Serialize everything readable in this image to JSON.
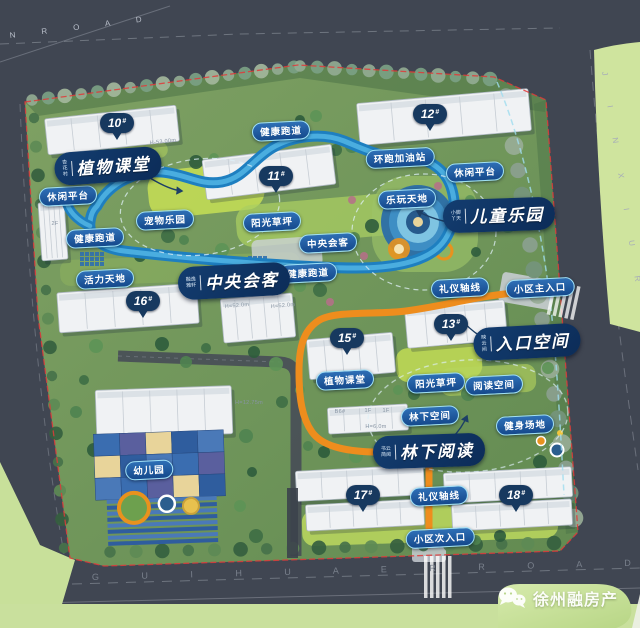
{
  "title": "residential community landscape master plan",
  "roads": {
    "top": "N  R O A D",
    "right": "J I N   X I U   R O A D",
    "bottom": "G U I   H U A   E R   R O A D"
  },
  "site": {
    "feature_labels": [
      {
        "text": "植物课堂",
        "prefix_lines": [
          "杏",
          "花",
          "村"
        ],
        "x": 108,
        "y": 166,
        "rot": -4
      },
      {
        "text": "中央会客",
        "prefix_lines": [
          "融逸",
          "雅轩"
        ],
        "x": 234,
        "y": 281,
        "rot": -3
      },
      {
        "text": "儿童乐园",
        "prefix_lines": [
          "小脚",
          "丫天"
        ],
        "x": 499,
        "y": 215,
        "rot": -2
      },
      {
        "text": "入口空间",
        "prefix_lines": [
          "映",
          "云",
          "间"
        ],
        "x": 527,
        "y": 342,
        "rot": -3
      },
      {
        "text": "林下阅读",
        "prefix_lines": [
          "书云",
          "简阅"
        ],
        "x": 429,
        "y": 451,
        "rot": -2
      }
    ],
    "amenity_pills": [
      {
        "text": "健康跑道",
        "x": 281,
        "y": 131
      },
      {
        "text": "环跑加油站",
        "x": 400,
        "y": 158
      },
      {
        "text": "休闲平台",
        "x": 475,
        "y": 172
      },
      {
        "text": "乐玩天地",
        "x": 407,
        "y": 199
      },
      {
        "text": "休闲平台",
        "x": 68,
        "y": 196
      },
      {
        "text": "宠物乐园",
        "x": 165,
        "y": 220
      },
      {
        "text": "阳光草坪",
        "x": 272,
        "y": 222
      },
      {
        "text": "中央会客",
        "x": 328,
        "y": 243
      },
      {
        "text": "健康跑道",
        "x": 95,
        "y": 238
      },
      {
        "text": "健康跑道",
        "x": 308,
        "y": 273
      },
      {
        "text": "活力天地",
        "x": 105,
        "y": 279
      },
      {
        "text": "礼仪轴线",
        "x": 460,
        "y": 288
      },
      {
        "text": "小区主入口",
        "x": 540,
        "y": 288
      },
      {
        "text": "植物课堂",
        "x": 345,
        "y": 380
      },
      {
        "text": "阳光草坪",
        "x": 436,
        "y": 383
      },
      {
        "text": "阅读空间",
        "x": 494,
        "y": 385
      },
      {
        "text": "林下空间",
        "x": 430,
        "y": 416
      },
      {
        "text": "健身场地",
        "x": 525,
        "y": 425
      },
      {
        "text": "礼仪轴线",
        "x": 439,
        "y": 496
      },
      {
        "text": "小区次入口",
        "x": 440,
        "y": 538
      },
      {
        "text": "幼儿园",
        "x": 149,
        "y": 470
      }
    ],
    "building_pins": [
      {
        "num": "10",
        "hash": "#",
        "x": 117,
        "y": 140
      },
      {
        "num": "11",
        "hash": "#",
        "x": 276,
        "y": 193
      },
      {
        "num": "12",
        "hash": "#",
        "x": 430,
        "y": 131
      },
      {
        "num": "13",
        "hash": "#",
        "x": 451,
        "y": 341
      },
      {
        "num": "15",
        "hash": "#",
        "x": 347,
        "y": 355
      },
      {
        "num": "16",
        "hash": "#",
        "x": 143,
        "y": 318
      },
      {
        "num": "17",
        "hash": "#",
        "x": 363,
        "y": 512
      },
      {
        "num": "18",
        "hash": "#",
        "x": 516,
        "y": 512
      }
    ],
    "building_notes": [
      {
        "text": "H-53.00m",
        "x": 163,
        "y": 142,
        "rot": -6
      },
      {
        "text": "H=52.0m",
        "x": 237,
        "y": 306,
        "rot": -5
      },
      {
        "text": "H=52.0m",
        "x": 283,
        "y": 306,
        "rot": -5
      },
      {
        "text": "2F",
        "x": 55,
        "y": 224,
        "rot": 0
      },
      {
        "text": "H=12.75m",
        "x": 249,
        "y": 403,
        "rot": 0
      },
      {
        "text": "B6#",
        "x": 340,
        "y": 412,
        "rot": 0
      },
      {
        "text": "1F",
        "x": 368,
        "y": 411,
        "rot": 0
      },
      {
        "text": "1F",
        "x": 386,
        "y": 411,
        "rot": 0
      },
      {
        "text": "H=6.0m",
        "x": 376,
        "y": 427,
        "rot": 0
      }
    ]
  },
  "watermark": {
    "brand": "徐州融房产",
    "icon": "wechat-icon"
  },
  "colors": {
    "road_gray": "#404652",
    "outer_green": "#cfe49e",
    "parcel_green": "#72975a",
    "lawn_bright": "#c2dc55",
    "ribbon_blue": "#1e7fc0",
    "ribbon_blue_light": "#4fb3e2",
    "axis_orange": "#ee8d1d",
    "pill_blue": "#15498c",
    "pill_border": "#9fe0f7",
    "label_navy": "#0c2c58",
    "boundary_red": "#e03a3a",
    "phase_dash_cyan": "#9fdcef"
  }
}
